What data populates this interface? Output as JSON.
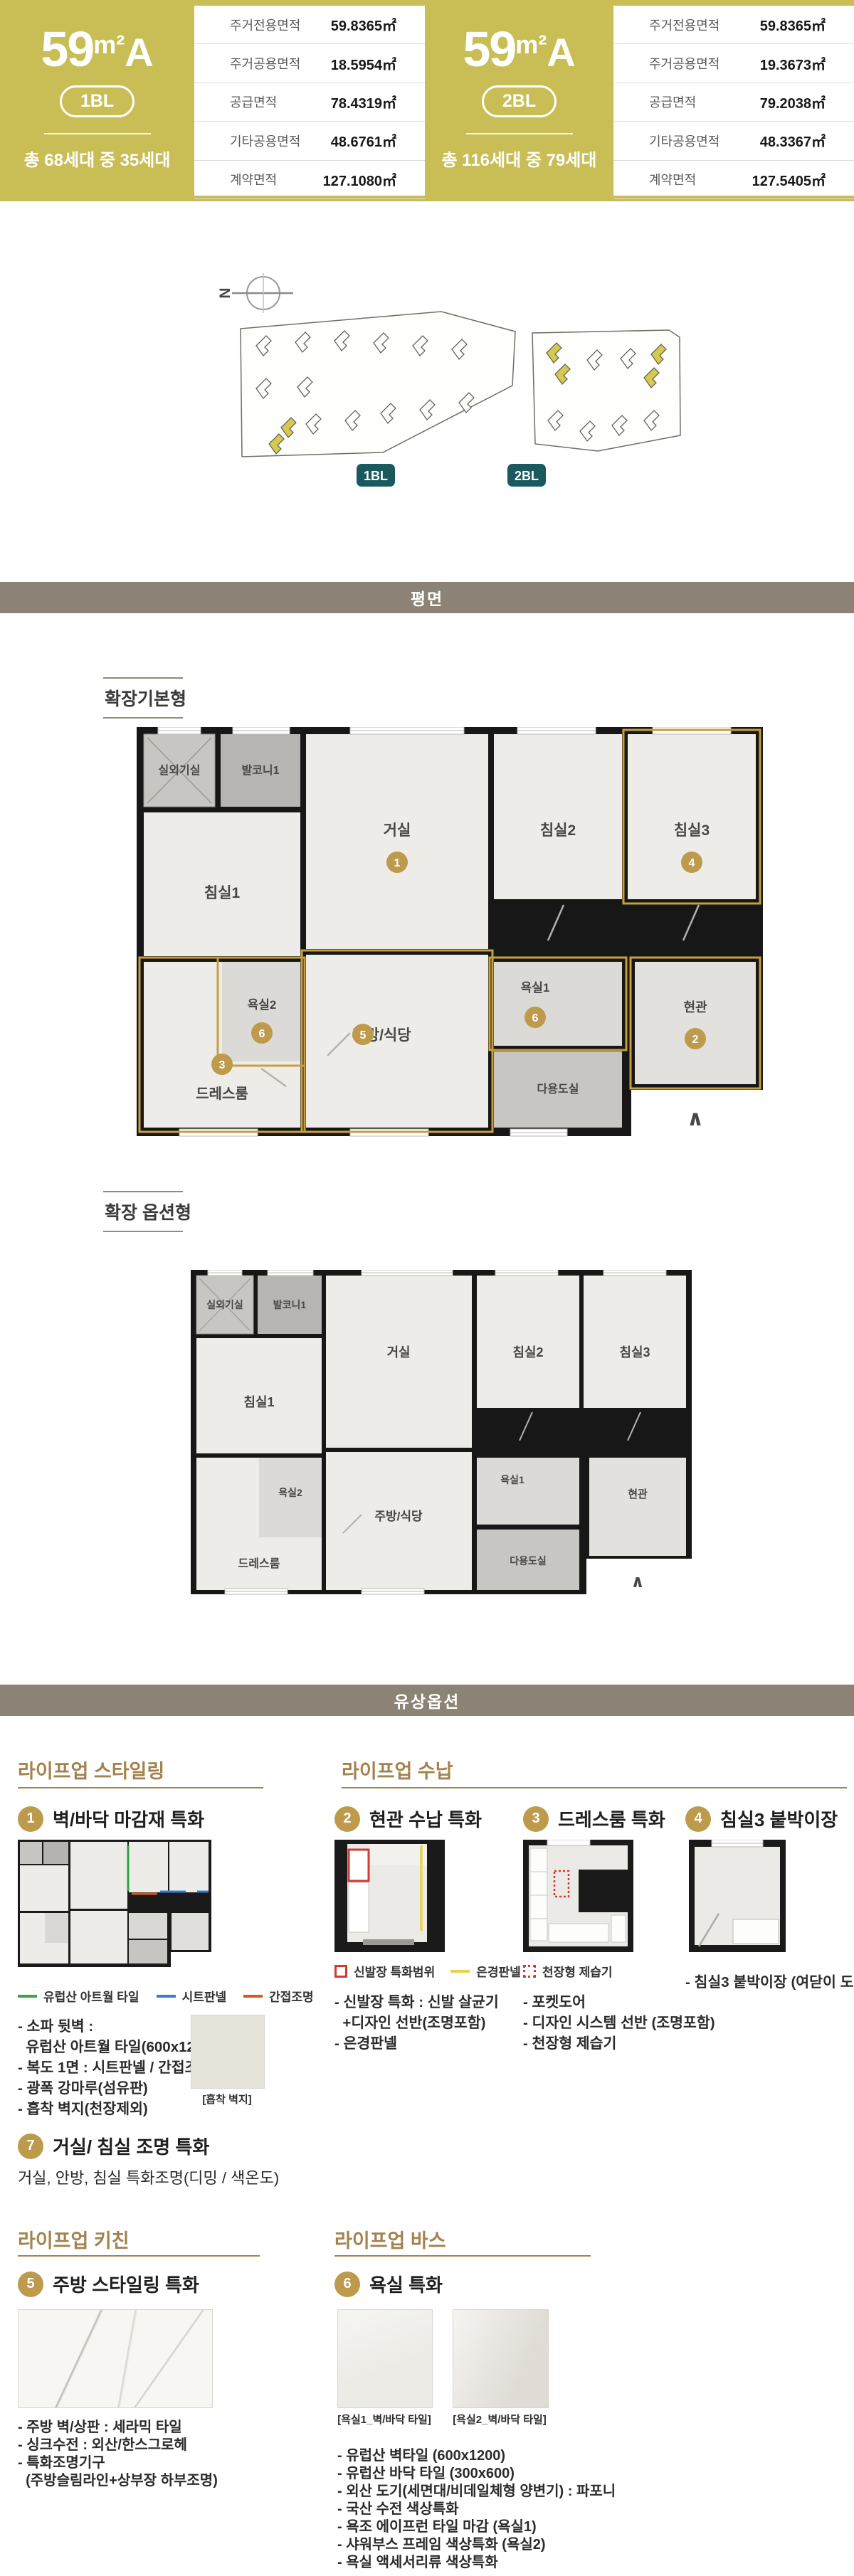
{
  "colors": {
    "band_olive": "#c9be55",
    "section_bar": "#8c8275",
    "accent_gold": "#a3824e",
    "badge_gold": "#bd9a4c",
    "block_badge_teal": "#1a5a5e",
    "plan_highlight_gold": "#c79f3f",
    "legend_green": "#3aa344",
    "legend_blue": "#2f7fd6",
    "legend_orange": "#e0521f",
    "legend_red": "#d23a32",
    "legend_yellow": "#e6d44f"
  },
  "units": [
    {
      "size": "59",
      "sup": "m²",
      "type": "A",
      "block": "1BL",
      "households": "총 68세대 중 35세대",
      "table": [
        {
          "label": "주거전용면적",
          "value": "59.8365㎡"
        },
        {
          "label": "주거공용면적",
          "value": "18.5954㎡"
        },
        {
          "label": "공급면적",
          "value": "78.4319㎡"
        },
        {
          "label": "기타공용면적",
          "value": "48.6761㎡"
        },
        {
          "label": "계약면적",
          "value": "127.1080㎡"
        }
      ]
    },
    {
      "size": "59",
      "sup": "m²",
      "type": "A",
      "block": "2BL",
      "households": "총 116세대 중 79세대",
      "table": [
        {
          "label": "주거전용면적",
          "value": "59.8365㎡"
        },
        {
          "label": "주거공용면적",
          "value": "19.3673㎡"
        },
        {
          "label": "공급면적",
          "value": "79.2038㎡"
        },
        {
          "label": "기타공용면적",
          "value": "48.3367㎡"
        },
        {
          "label": "계약면적",
          "value": "127.5405㎡"
        }
      ]
    }
  ],
  "site": {
    "compass": "N",
    "blocks": [
      "1BL",
      "2BL"
    ]
  },
  "sections": {
    "plan": "평면",
    "paid": "유상옵션"
  },
  "plans": {
    "basic": {
      "label": "확장기본형",
      "arrow": "∧",
      "rooms": {
        "outdoor": "실외기실",
        "balcony": "발코니1",
        "living": "거실",
        "bed2": "침실2",
        "bed3": "침실3",
        "bed1": "침실1",
        "bath2": "욕실2",
        "bath1": "욕실1",
        "dress": "드레스룸",
        "kitchen": "주방/식당",
        "utility": "다용도실",
        "entrance": "현관"
      },
      "badges": {
        "living": "1",
        "entrance": "2",
        "dress": "3",
        "bed3": "4",
        "kitchen": "5",
        "bath1": "6",
        "bath2": "6"
      }
    },
    "option": {
      "label": "확장 옵션형",
      "arrow": "∧",
      "rooms": {
        "outdoor": "실외기실",
        "balcony": "발코니1",
        "living": "거실",
        "bed2": "침실2",
        "bed3": "침실3",
        "bed1": "침실1",
        "bath2": "욕실2",
        "bath1": "욕실1",
        "dress": "드레스룸",
        "kitchen": "주방/식당",
        "utility": "다용도실",
        "entrance": "현관"
      }
    }
  },
  "groups": {
    "styling": "라이프업 스타일링",
    "storage": "라이프업 수납",
    "kitchen": "라이프업 키친",
    "bath": "라이프업 바스"
  },
  "options": [
    {
      "num": "1",
      "title": "벽/바닥 마감재 특화",
      "legend": [
        {
          "label": "유럽산 아트월 타일",
          "color": "#3aa344"
        },
        {
          "label": "시트판넬",
          "color": "#2f7fd6"
        },
        {
          "label": "간접조명",
          "color": "#e0521f"
        }
      ],
      "lines": [
        "- 소파 뒷벽 :",
        "  유럽산 아트월 타일(600x1200)",
        "- 복도 1면 : 시트판넬 / 간접조명",
        "- 광폭 강마루(섬유판)",
        "- 흡착 벽지(천장제외)"
      ],
      "caption": "[흡착 벽지]"
    },
    {
      "num": "2",
      "title": "현관 수납 특화",
      "legend": [
        {
          "label": "신발장 특화범위",
          "color": "#d23a32"
        },
        {
          "label": "은경판넬",
          "color": "#e6d44f"
        }
      ],
      "lines": [
        "- 신발장 특화 : 신발 살균기",
        "  +디자인 선반(조명포함)",
        "- 은경판넬"
      ]
    },
    {
      "num": "3",
      "title": "드레스룸 특화",
      "legend": [
        {
          "label": "천장형 제습기",
          "color": "#d23a32"
        }
      ],
      "lines": [
        "- 포켓도어",
        "- 디자인 시스템 선반 (조명포함)",
        "- 천장형 제습기"
      ]
    },
    {
      "num": "4",
      "title": "침실3 붙박이장",
      "lines": [
        "- 침실3 붙박이장 (여닫이 도어)"
      ]
    },
    {
      "num": "7",
      "title": "거실/ 침실 조명 특화",
      "desc": "거실, 안방, 침실 특화조명(디밍 / 색온도)"
    },
    {
      "num": "5",
      "title": "주방 스타일링 특화",
      "lines": [
        "- 주방 벽/상판 : 세라믹 타일",
        "- 싱크수전 : 외산/한스그로헤",
        "- 특화조명기구",
        "  (주방슬림라인+상부장 하부조명)"
      ]
    },
    {
      "num": "6",
      "title": "욕실 특화",
      "captions": [
        "[욕실1_벽/바닥 타일]",
        "[욕실2_벽/바닥 타일]"
      ],
      "lines": [
        "- 유럽산 벽타일 (600x1200)",
        "- 유럽산 바닥 타일 (300x600)",
        "- 외산 도기(세면대/비데일체형 양변기) : 파포니",
        "- 국산 수전 색상특화",
        "- 욕조 에이프런 타일 마감 (욕실1)",
        "- 샤워부스 프레임 색상특화 (욕실2)",
        "- 욕실 액세서리류 색상특화"
      ]
    }
  ]
}
